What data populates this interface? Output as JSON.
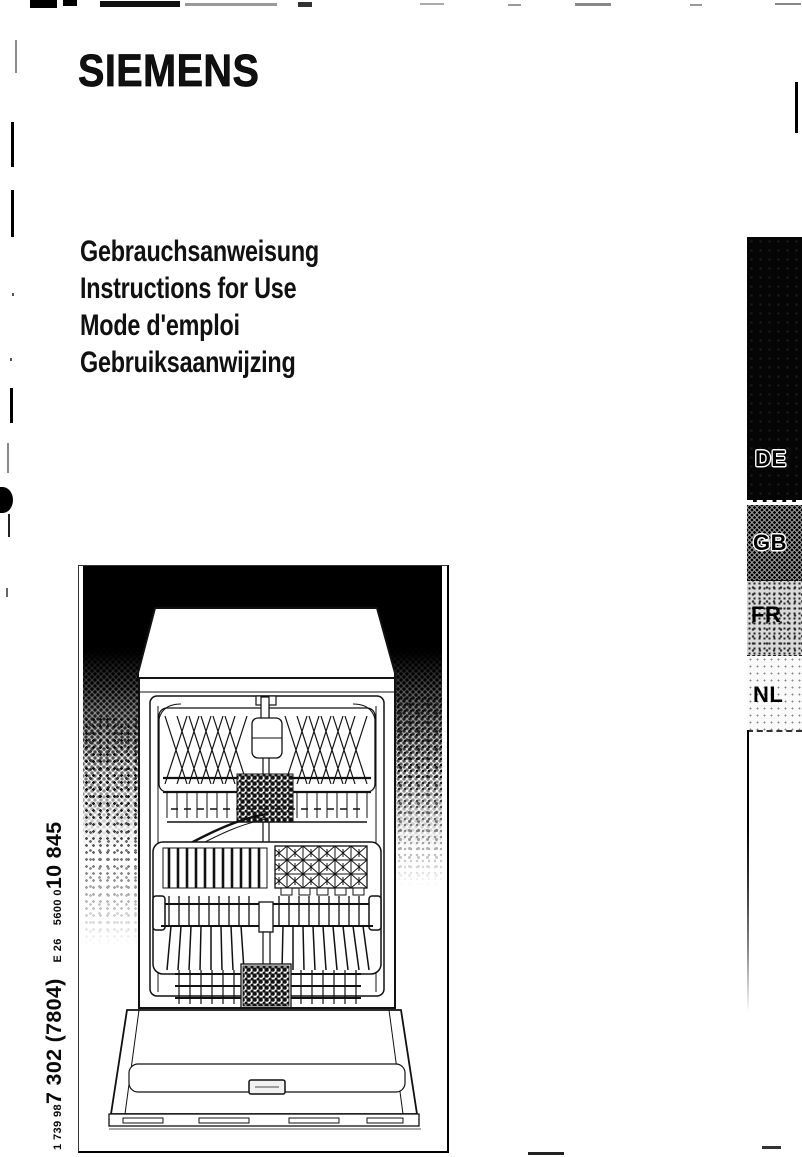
{
  "document": {
    "brand": "SIEMENS",
    "titles": [
      "Gebrauchsanweisung",
      "Instructions for Use",
      "Mode d'emploi",
      "Gebruiksaanwijzing"
    ],
    "language_tabs": {
      "labels": [
        "DE",
        "GB",
        "FR",
        "NL"
      ]
    },
    "print_code": {
      "order_number_small": "1 739 98",
      "order_number_large": "7 302 (7804)",
      "edition": "E 26",
      "material_number_small": "5600 0",
      "material_number_large": "10 845"
    },
    "illustration": "dishwasher-front-open-line-drawing",
    "colors": {
      "ink": "#111111",
      "tab_black": "#000000",
      "paper": "#ffffff"
    }
  }
}
